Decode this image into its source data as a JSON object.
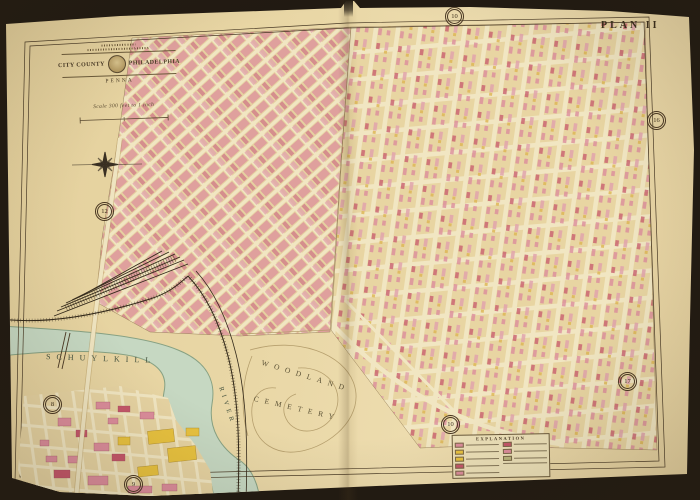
{
  "page": {
    "plan_label": "PLAN II",
    "plate_badges": [
      {
        "position": "top-center",
        "label": "10"
      },
      {
        "position": "right-edge",
        "label": "16"
      },
      {
        "position": "left-center",
        "label": "12"
      },
      {
        "position": "bottom-right",
        "label": "17"
      },
      {
        "position": "river-left",
        "label": "8"
      },
      {
        "position": "bottom-center",
        "label": "10"
      },
      {
        "position": "bottom-left",
        "label": "9"
      }
    ]
  },
  "cartouche": {
    "title_left": "CITY COUNTY",
    "title_right": "PHILADELPHIA",
    "subtitle": "PENNA",
    "scale_text": "Scale 300 feet to 1 inch"
  },
  "labels": {
    "river_name": "SCHUYLKILL",
    "river_word": "RIVER",
    "cemetery_line1": "WOODLAND",
    "cemetery_line2": "CEMETERY"
  },
  "legend": {
    "title": "EXPLANATION",
    "swatches_left": [
      "#dc8d9c",
      "#e8c23f",
      "#e8c23f",
      "#c5566a",
      "#dc8d9c"
    ],
    "swatches_right": [
      "#c5566a",
      "#dc8d9c",
      "#b9b57c"
    ]
  },
  "colors": {
    "paper": "#e7d5a4",
    "river": "#c6d8c2",
    "building_pink": "#dc8d9c",
    "building_red": "#c5566a",
    "building_yellow": "#e8c23f",
    "street_cream": "#f1e6c2",
    "ink": "#44361f"
  }
}
